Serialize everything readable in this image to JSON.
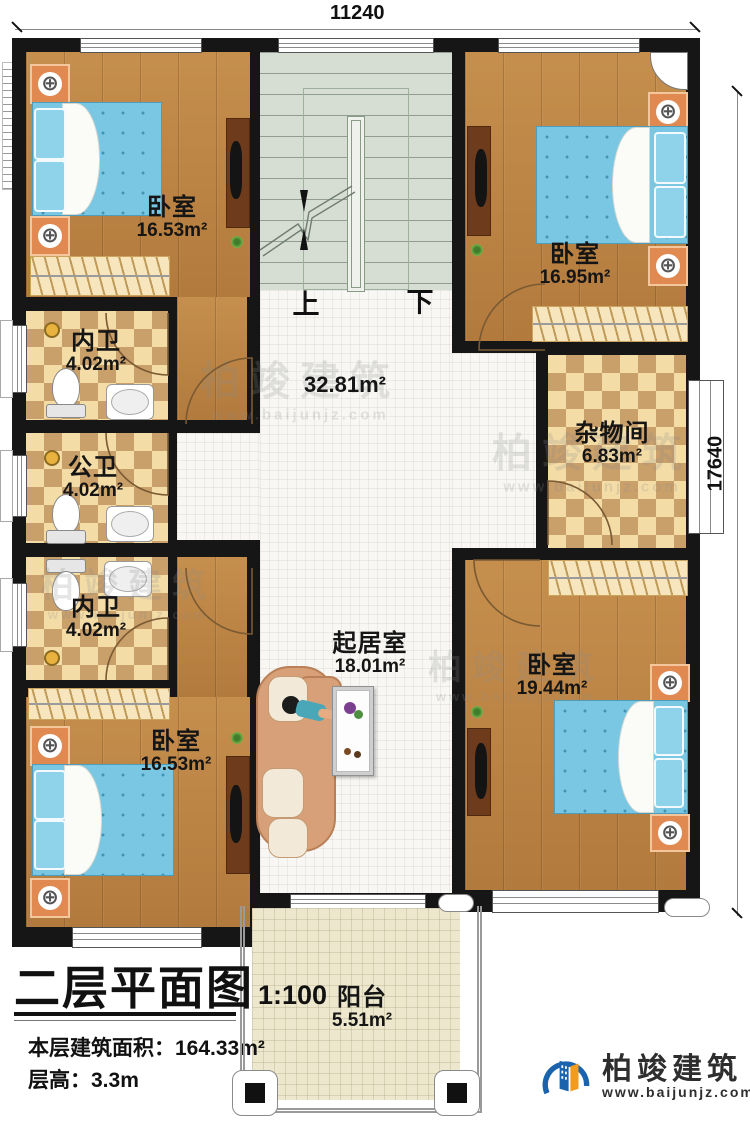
{
  "plan": {
    "dimensions": {
      "top": "11240",
      "right": "17640"
    },
    "stairs": {
      "up": "上",
      "down": "下"
    },
    "rooms": {
      "bedroom_tl": {
        "name": "卧室",
        "area": "16.53m²"
      },
      "bedroom_tr": {
        "name": "卧室",
        "area": "16.95m²"
      },
      "bedroom_bl": {
        "name": "卧室",
        "area": "16.53m²"
      },
      "bedroom_br": {
        "name": "卧室",
        "area": "19.44m²"
      },
      "bath_top": {
        "name": "内卫",
        "area": "4.02m²"
      },
      "bath_mid": {
        "name": "公卫",
        "area": "4.02m²"
      },
      "bath_bottom": {
        "name": "内卫",
        "area": "4.02m²"
      },
      "storage": {
        "name": "杂物间",
        "area": "6.83m²"
      },
      "hall": {
        "area": "32.81m²"
      },
      "living": {
        "name": "起居室",
        "area": "18.01m²"
      },
      "balcony": {
        "name": "阳台",
        "area": "5.51m²"
      }
    }
  },
  "title_block": {
    "title": "二层平面图",
    "scale": "1:100",
    "floor_area": "本层建筑面积：164.33m²",
    "floor_height": "层高：3.3m"
  },
  "brand": {
    "name": "柏竣建筑",
    "url": "www.baijunjz.com"
  },
  "watermark": {
    "name": "柏竣建筑",
    "url": "www.baijunjz.com"
  },
  "icons": {
    "lamp": "⊕"
  },
  "colors": {
    "wall": "#161616",
    "wood": "#bc8343",
    "checker_light": "#f4dca6",
    "checker_dark": "#c99f6a",
    "stair": "#d6ddd3",
    "hall_tile": "#f8f7f4",
    "balcony": "#ece7cd",
    "bed": "#7ac7e3",
    "brand_blue": "#1b63ad",
    "brand_orange": "#f29b1d"
  }
}
